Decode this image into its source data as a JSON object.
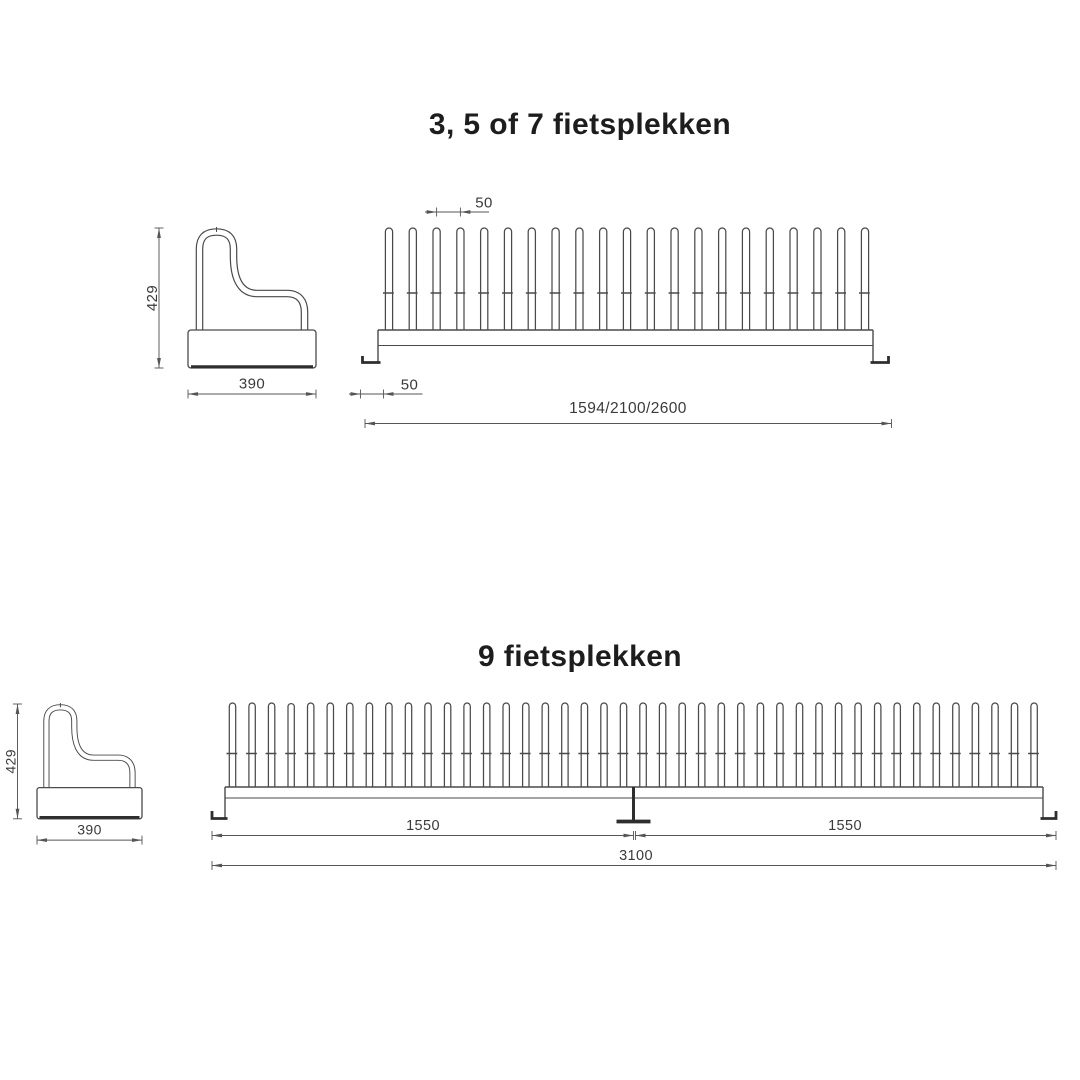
{
  "colors": {
    "background": "#ffffff",
    "line": "#4a4a4a",
    "bold": "#2e2e2e",
    "dim": "#555555",
    "dim_text": "#3a3a3a",
    "title_text": "#1d1d1d"
  },
  "diagram1": {
    "title": "3, 5 of 7 fietsplekken",
    "side_view": {
      "height": "429",
      "width": "390"
    },
    "front_view": {
      "tine_count": 21,
      "pitch": "50",
      "end_offset": "50",
      "length": "1594/2100/2600"
    }
  },
  "diagram2": {
    "title": "9 fietsplekken",
    "side_view": {
      "height": "429",
      "width": "390"
    },
    "front_view": {
      "tine_count": 42,
      "segment_left": "1550",
      "segment_right": "1550",
      "total_length": "3100"
    }
  }
}
